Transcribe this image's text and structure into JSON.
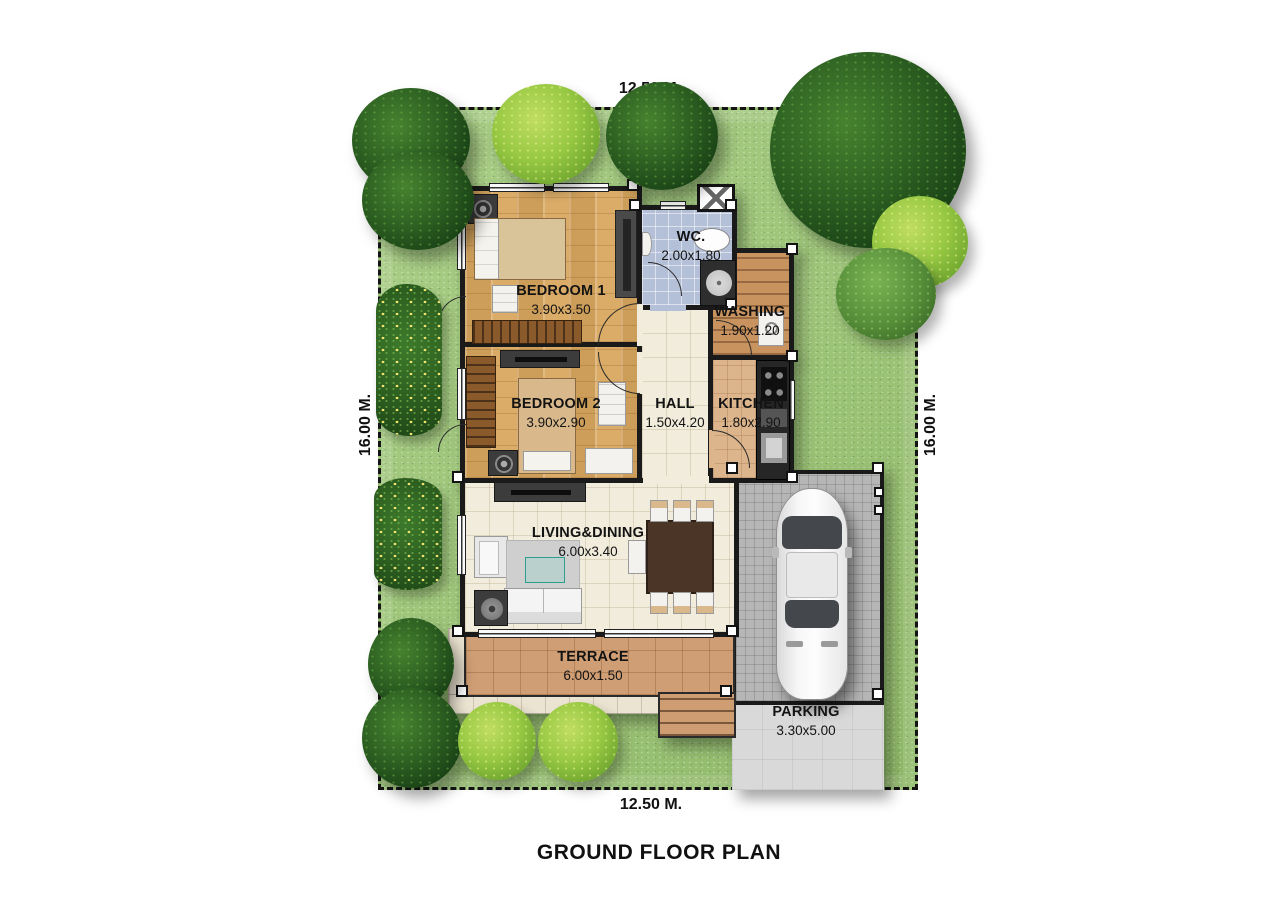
{
  "title": "GROUND FLOOR PLAN",
  "plot_dimensions": {
    "top": "12.50 M.",
    "bottom": "12.50 M.",
    "left": "16.00 M.",
    "right": "16.00 M."
  },
  "rooms": {
    "bedroom1": {
      "name": "BEDROOM 1",
      "size": "3.90x3.50"
    },
    "wc": {
      "name": "WC.",
      "size": "2.00x1.80"
    },
    "washing": {
      "name": "WASHING",
      "size": "1.90x1.20"
    },
    "bedroom2": {
      "name": "BEDROOM 2",
      "size": "3.90x2.90"
    },
    "hall": {
      "name": "HALL",
      "size": "1.50x4.20"
    },
    "kitchen": {
      "name": "KITCHEN",
      "size": "1.80x2.90"
    },
    "living_dining": {
      "name": "LIVING&DINING",
      "size": "6.00x3.40"
    },
    "terrace": {
      "name": "TERRACE",
      "size": "6.00x1.50"
    },
    "parking": {
      "name": "PARKING",
      "size": "3.30x5.00"
    }
  },
  "colors": {
    "grass": "#9AC671",
    "walls": "#1A1A1A",
    "wood_floor": "#D8A75F",
    "tile_cream": "#F1ECDC",
    "tile_blue_wc": "#B4C0D8",
    "terracotta": "#CF9E74",
    "paver_grey": "#B6B6B6",
    "concrete": "#D9D9D9",
    "tree_dark": "#2F6323",
    "tree_light": "#97C843"
  }
}
